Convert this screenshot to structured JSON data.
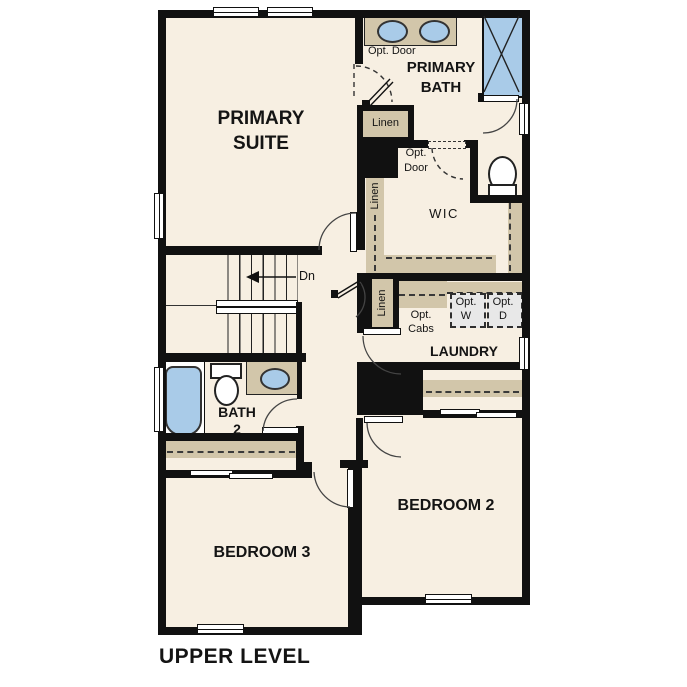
{
  "title": "UPPER LEVEL",
  "rooms": {
    "primary_suite": {
      "name_line1": "PRIMARY",
      "name_line2": "SUITE"
    },
    "primary_bath": {
      "name_line1": "PRIMARY",
      "name_line2": "BATH"
    },
    "wic": {
      "name": "WIC"
    },
    "laundry": {
      "name": "LAUNDRY"
    },
    "bath_2": {
      "name_line1": "BATH",
      "name_line2": "2"
    },
    "bedroom_2": {
      "name": "BEDROOM 2"
    },
    "bedroom_3": {
      "name": "BEDROOM 3"
    }
  },
  "labels": {
    "opt_door_primary_bath": "Opt. Door",
    "opt_door_wic_line1": "Opt.",
    "opt_door_wic_line2": "Door",
    "linen_primary_bath": "Linen",
    "linen_wic": "Linen",
    "linen_hall": "Linen",
    "opt_cabs_line1": "Opt.",
    "opt_cabs_line2": "Cabs",
    "opt_washer_line1": "Opt.",
    "opt_washer_line2": "W",
    "opt_dryer_line1": "Opt.",
    "opt_dryer_line2": "D",
    "stairs_down": "Dn"
  },
  "colors": {
    "floor": "#f7efe2",
    "wall": "#111111",
    "casework_tan": "#d2c6aa",
    "fixture_blue": "#a9cbe8",
    "appliance_gray": "#e8e8e8"
  }
}
